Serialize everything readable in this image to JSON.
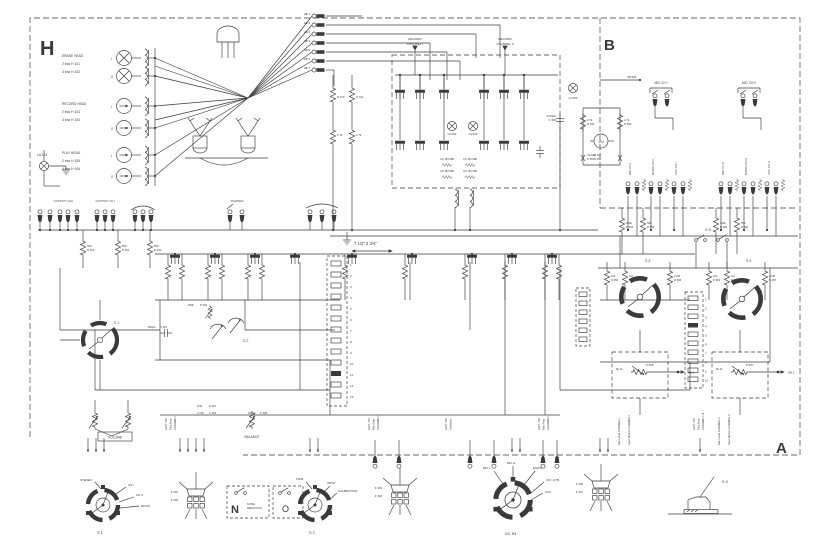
{
  "sections": {
    "h": "H",
    "b": "B",
    "a": "A"
  },
  "heads": {
    "erase": {
      "title": "ERASE HEAD",
      "rows": [
        "2 trac H 101",
        "4 trac H 102"
      ]
    },
    "record": {
      "title": "RECORD HEAD",
      "rows": [
        "2 trac H 103",
        "4 trac H 104"
      ]
    },
    "play": {
      "title": "PLAY HEAD",
      "rows": [
        "2 trac H 105",
        "4 trac H 106"
      ]
    },
    "numerals": [
      "I",
      "II"
    ],
    "lamp": "LA 101"
  },
  "connector": {
    "pins": [
      "HB 1",
      "HB 2",
      "HB 3",
      "HB 4",
      "HB 5",
      "HB 6",
      "HB 7"
    ]
  },
  "record_amp": {
    "channel1": [
      "RECORD",
      "CHANNEL I"
    ],
    "channel2": [
      "RECORD",
      "CHANNEL II"
    ],
    "lamps": [
      "LA 502",
      "LA 503"
    ],
    "transistor_type": "AC 187/188",
    "res": [
      {
        "v": "",
        "r": "R 100"
      },
      {
        "v": "",
        "r": "R 101"
      },
      {
        "v": "2.7k",
        "r": ""
      },
      {
        "v": "2.7k",
        "r": ""
      }
    ]
  },
  "meter": {
    "label": "VU",
    "cap": {
      "v": "4700μF",
      "r": "C 353"
    },
    "res": [
      {
        "v": "2.7k",
        "r": "R 351"
      },
      {
        "v": "2.7k",
        "r": "R 352"
      }
    ],
    "diodes": [
      {
        "v": "AA 116",
        "r": "D 353"
      },
      {
        "v": "AA 116",
        "r": "D 354"
      }
    ],
    "lamp": "LA 500",
    "wire": "AB 582"
  },
  "inputs": {
    "mic1": "MIC CH I",
    "mic2": "MIC CH II",
    "columns": [
      "MIC CH I",
      "RADIO CH I",
      "AUX CH I",
      "MIC CH II",
      "RADIO CH II",
      "AUX CH II"
    ]
  },
  "outputs": {
    "ch2": "OUTPUT CHII",
    "ch1": "OUTPUT CH I",
    "phones": "PHONES",
    "res": [
      {
        "v": "560",
        "r": "R 300"
      },
      {
        "v": "560",
        "r": "R 301"
      },
      {
        "v": "560",
        "r": "R 302"
      }
    ]
  },
  "speed": "7 1/2\" 3 3/4\"",
  "switch_labels": {
    "s1": "S 1",
    "s2": "S 2",
    "s3": "S 3",
    "s4": "S 4",
    "s5": "S 5"
  },
  "controls": {
    "volume": "VOLUME",
    "balance": "BALANCE"
  },
  "mid_components": [
    {
      "v": "600pF",
      "r": "C 301"
    },
    {
      "v": "250k",
      "r": "P 303"
    },
    {
      "v": "6.8k",
      "r": "R 307"
    },
    {
      "v": "4.7μF",
      "r": "C 304"
    },
    {
      "v": "250μF",
      "r": "C 305"
    }
  ],
  "s3s4_area": {
    "above": [
      {
        "v": "220k",
        "r": "R 354"
      },
      {
        "v": "56k",
        "r": "R 355"
      },
      {
        "v": "220k",
        "r": "R 359"
      },
      {
        "v": "56k",
        "r": "R 360"
      }
    ],
    "below": [
      {
        "v": "10k",
        "r": "R 356"
      },
      {
        "v": "1M",
        "r": "R 357"
      },
      {
        "v": "2.2M",
        "r": "R 366"
      },
      {
        "v": "10k",
        "r": "R 363"
      },
      {
        "v": "1M",
        "r": "R 364"
      },
      {
        "v": "2.2M",
        "r": "R 367"
      }
    ]
  },
  "amp_blocks": [
    [
      "LEFT 700",
      "Play Amp",
      "CHANNEL I"
    ],
    [
      "LEFT 710",
      "Rec Amp",
      "CHANNEL II"
    ],
    [
      "LEFT 730",
      "Oscillator",
      ""
    ],
    [
      "LEFT 720",
      "Rec Amp",
      "CHANNEL I"
    ],
    [
      "LEFT 750",
      "Play Amp",
      "CHANNEL I+II"
    ]
  ],
  "rec_level": {
    "left": [
      "Rec Level CHANNEL I",
      "Input Device CHANNEL I"
    ],
    "right": [
      "Rec Level CHANNEL II",
      "Input Device CHANNEL II"
    ],
    "pots": [
      "P 506",
      "P 507"
    ],
    "value": "5k lin",
    "terms": [
      "AB 1",
      "AB 2"
    ]
  },
  "strips": {
    "left": [
      "1",
      "2",
      "3",
      "4",
      "5",
      "6",
      "7",
      "8",
      "9",
      "10",
      "11",
      "12",
      "13"
    ],
    "right": [
      "1",
      "2",
      "3",
      "4",
      "5",
      "6",
      "7",
      "8",
      "9",
      "10"
    ]
  },
  "details": {
    "s1": {
      "labels": [
        "STEREO",
        "CH I",
        "CH II",
        "MONO"
      ],
      "caption": "S 1"
    },
    "plug1": {
      "labels": [
        "F 501",
        "F 502"
      ]
    },
    "noise": {
      "n": "N",
      "text": [
        "NOISE",
        "REDUCTION"
      ],
      "o": "O"
    },
    "s2": {
      "labels": [
        "TAPE",
        "INPUT",
        "CALIBRATION"
      ],
      "caption": "S 2"
    },
    "plug2": {
      "labels": [
        "F 303",
        "F 304"
      ]
    },
    "s3s4": {
      "labels": [
        "MIC L",
        "MIC H",
        "RADIO",
        "CD I (178)",
        "AUX"
      ],
      "caption": "S3, S4"
    },
    "plug3": {
      "labels": [
        "F 306",
        "F 307"
      ]
    },
    "s5": {
      "caption": "S 5"
    }
  }
}
